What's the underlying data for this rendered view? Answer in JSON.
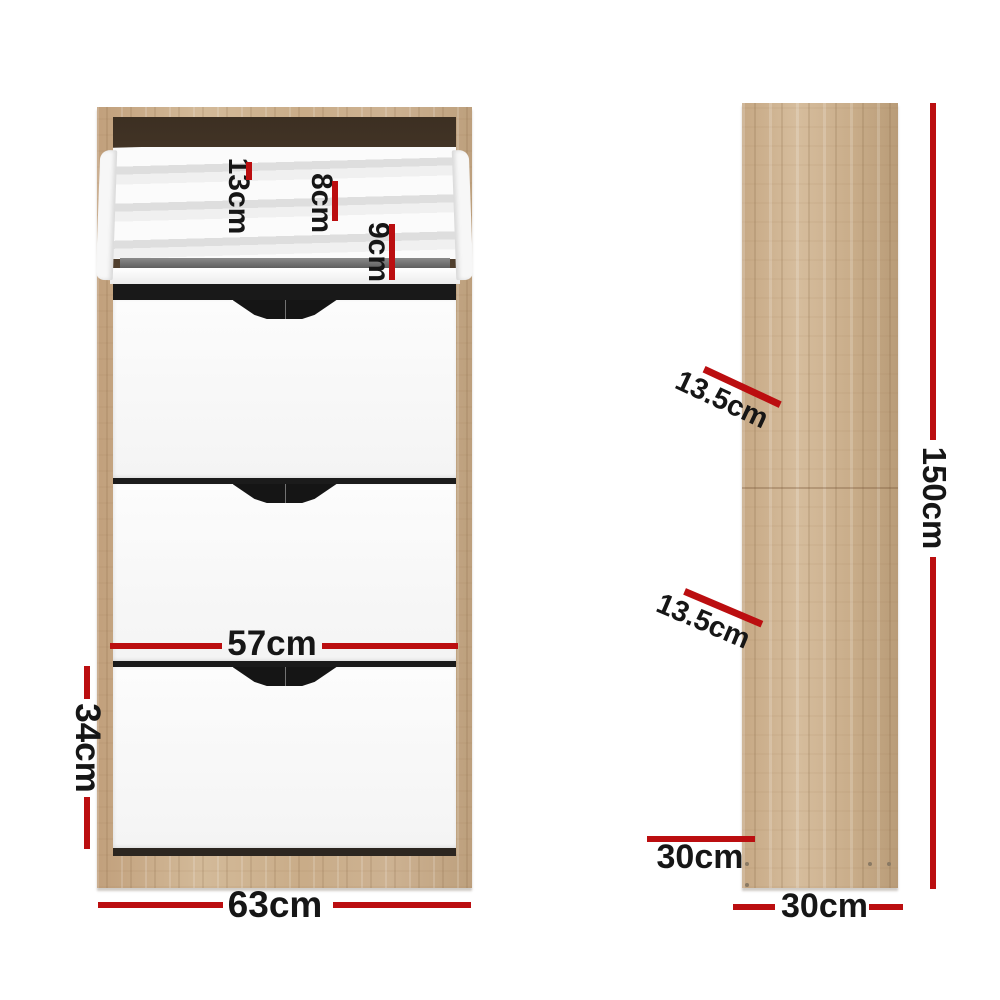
{
  "title": "Shoe cabinet dimension diagram",
  "colors": {
    "red": "#bb0e10",
    "wood": "#c9ab89",
    "interior": "#463628",
    "drawer": "#fafafa"
  },
  "front_view": {
    "dims": {
      "tier_top": "13cm",
      "tier_mid": "8cm",
      "tier_bottom": "9cm",
      "drawer_width": "57cm",
      "drawer_height": "34cm",
      "cabinet_width": "63cm"
    }
  },
  "side_view": {
    "dims": {
      "shelf_gap_upper": "13.5cm",
      "shelf_gap_lower": "13.5cm",
      "cabinet_height": "150cm",
      "shelf_depth": "30cm",
      "cabinet_depth": "30cm"
    }
  }
}
